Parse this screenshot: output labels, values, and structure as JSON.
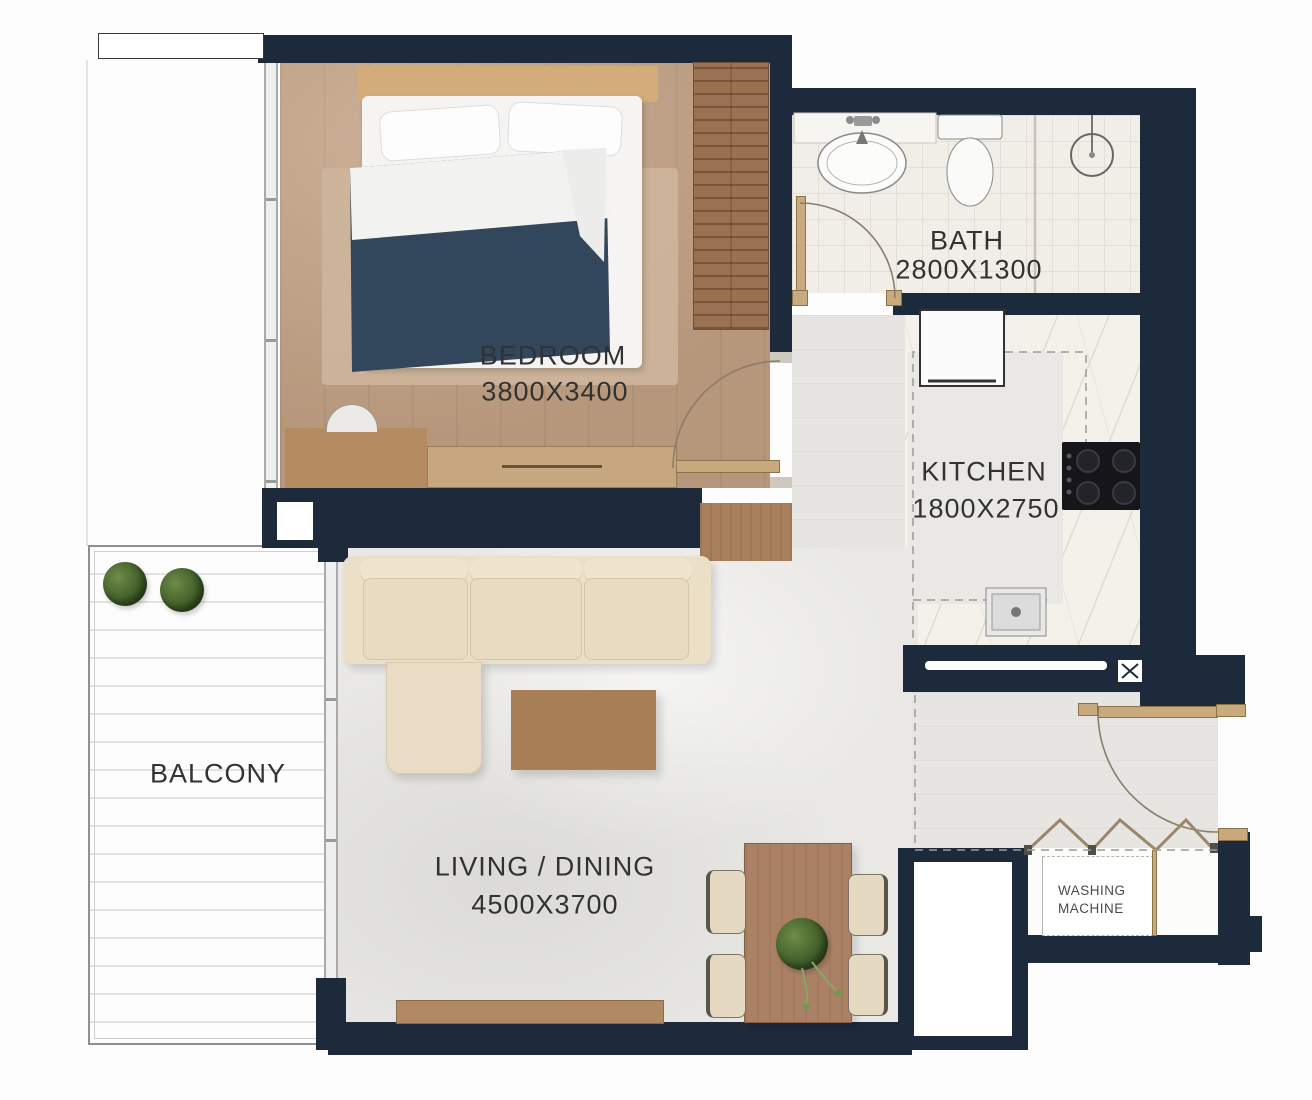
{
  "rooms": {
    "bedroom": {
      "name": "BEDROOM",
      "dimensions": "3800X3400"
    },
    "bath": {
      "name": "BATH",
      "dimensions": "2800X1300"
    },
    "kitchen": {
      "name": "KITCHEN",
      "dimensions": "1800X2750"
    },
    "living_dining": {
      "name": "LIVING / DINING",
      "dimensions": "4500X3700"
    },
    "balcony": {
      "name": "BALCONY"
    },
    "washing_machine": {
      "name_line1": "WASHING",
      "name_line2": "MACHINE"
    }
  },
  "colors": {
    "wall": "#1d2a3c",
    "wood-floor": "#b6977c",
    "door": "#c9a97e",
    "duvet": "#32465c",
    "sofa": "#ecdfc8",
    "counter-marble": "#f3f1ea",
    "tile": "#e6e5e2",
    "accent-green": "#4e6b33"
  }
}
